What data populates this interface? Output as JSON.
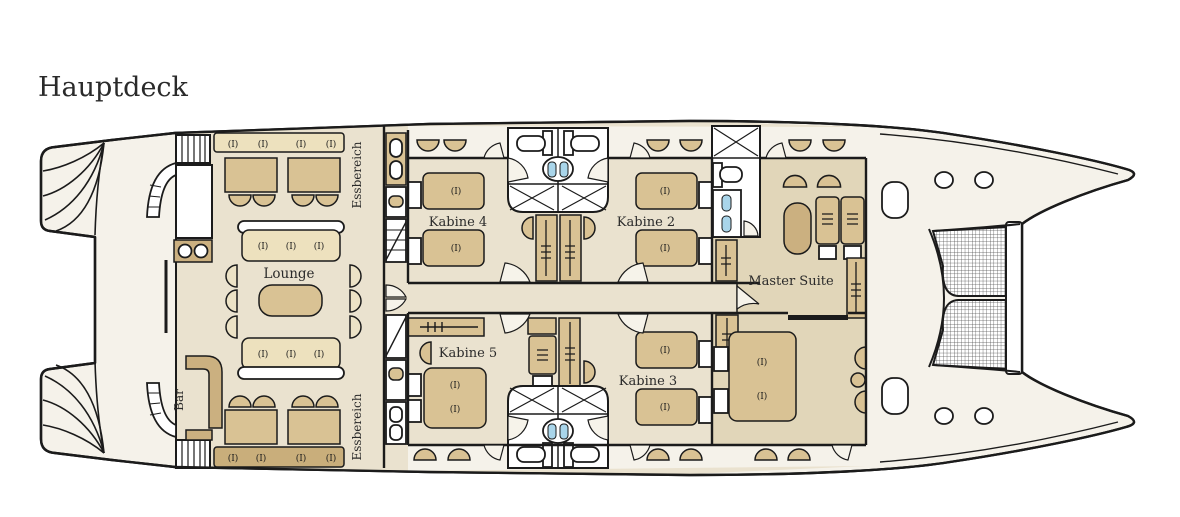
{
  "title": "Hauptdeck",
  "rooms": [
    {
      "id": "lounge",
      "label": "Lounge"
    },
    {
      "id": "bar",
      "label": "Bar"
    },
    {
      "id": "dining-top",
      "label": "Essbereich"
    },
    {
      "id": "dining-bottom",
      "label": "Essbereich"
    },
    {
      "id": "cabin-4",
      "label": "Kabine 4"
    },
    {
      "id": "cabin-2",
      "label": "Kabine 2"
    },
    {
      "id": "cabin-5",
      "label": "Kabine 5"
    },
    {
      "id": "cabin-3",
      "label": "Kabine 3"
    },
    {
      "id": "master-suite",
      "label": "Master Suite"
    }
  ],
  "symbols": {
    "seat_cushion": "(I)"
  },
  "colors": {
    "outline": "#1b1b1b",
    "floor": "#eae2cf",
    "master_floor": "#e1d6b9",
    "furniture_tan": "#d9c294",
    "bench_light": "#ede1be",
    "bench_dark": "#c9ae7b",
    "counter_tan": "#cbb080",
    "chair_cream": "#ece2c6",
    "hull_white": "#f5f2ea",
    "accent_blue": "#a9d5ea"
  }
}
